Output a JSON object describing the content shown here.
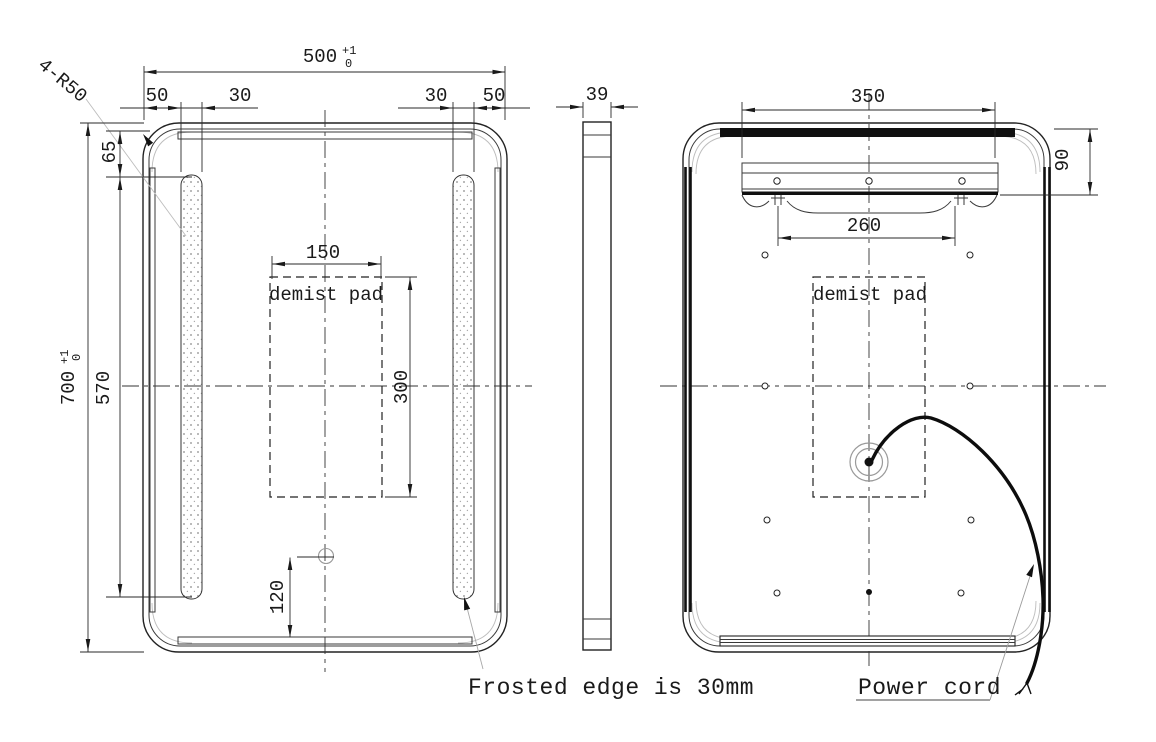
{
  "front_view": {
    "width": {
      "value": "500",
      "tol_plus": "+1",
      "tol_minus": "0"
    },
    "height": {
      "value": "700",
      "tol_plus": "+1",
      "tol_minus": "0"
    },
    "corner_note": "4-R50",
    "edge_offset_left": "50",
    "strip_width_left": "30",
    "strip_width_right": "30",
    "edge_offset_right": "50",
    "strip_top_offset": "65",
    "strip_length": "570",
    "demist_pad": {
      "label": "demist pad",
      "width": "150",
      "height": "300"
    },
    "switch_height": "120"
  },
  "side_view": {
    "thickness": "39"
  },
  "back_view": {
    "bracket_width": "350",
    "hanger_spacing": "260",
    "bracket_drop": "90",
    "demist_pad": {
      "label": "demist pad"
    }
  },
  "notes": {
    "frosted_edge": "Frosted edge is 30mm",
    "power_cord": "Power cord"
  },
  "colors": {
    "line": "#1a1a1a",
    "aux": "#bdbdbd",
    "background": "#ffffff"
  }
}
